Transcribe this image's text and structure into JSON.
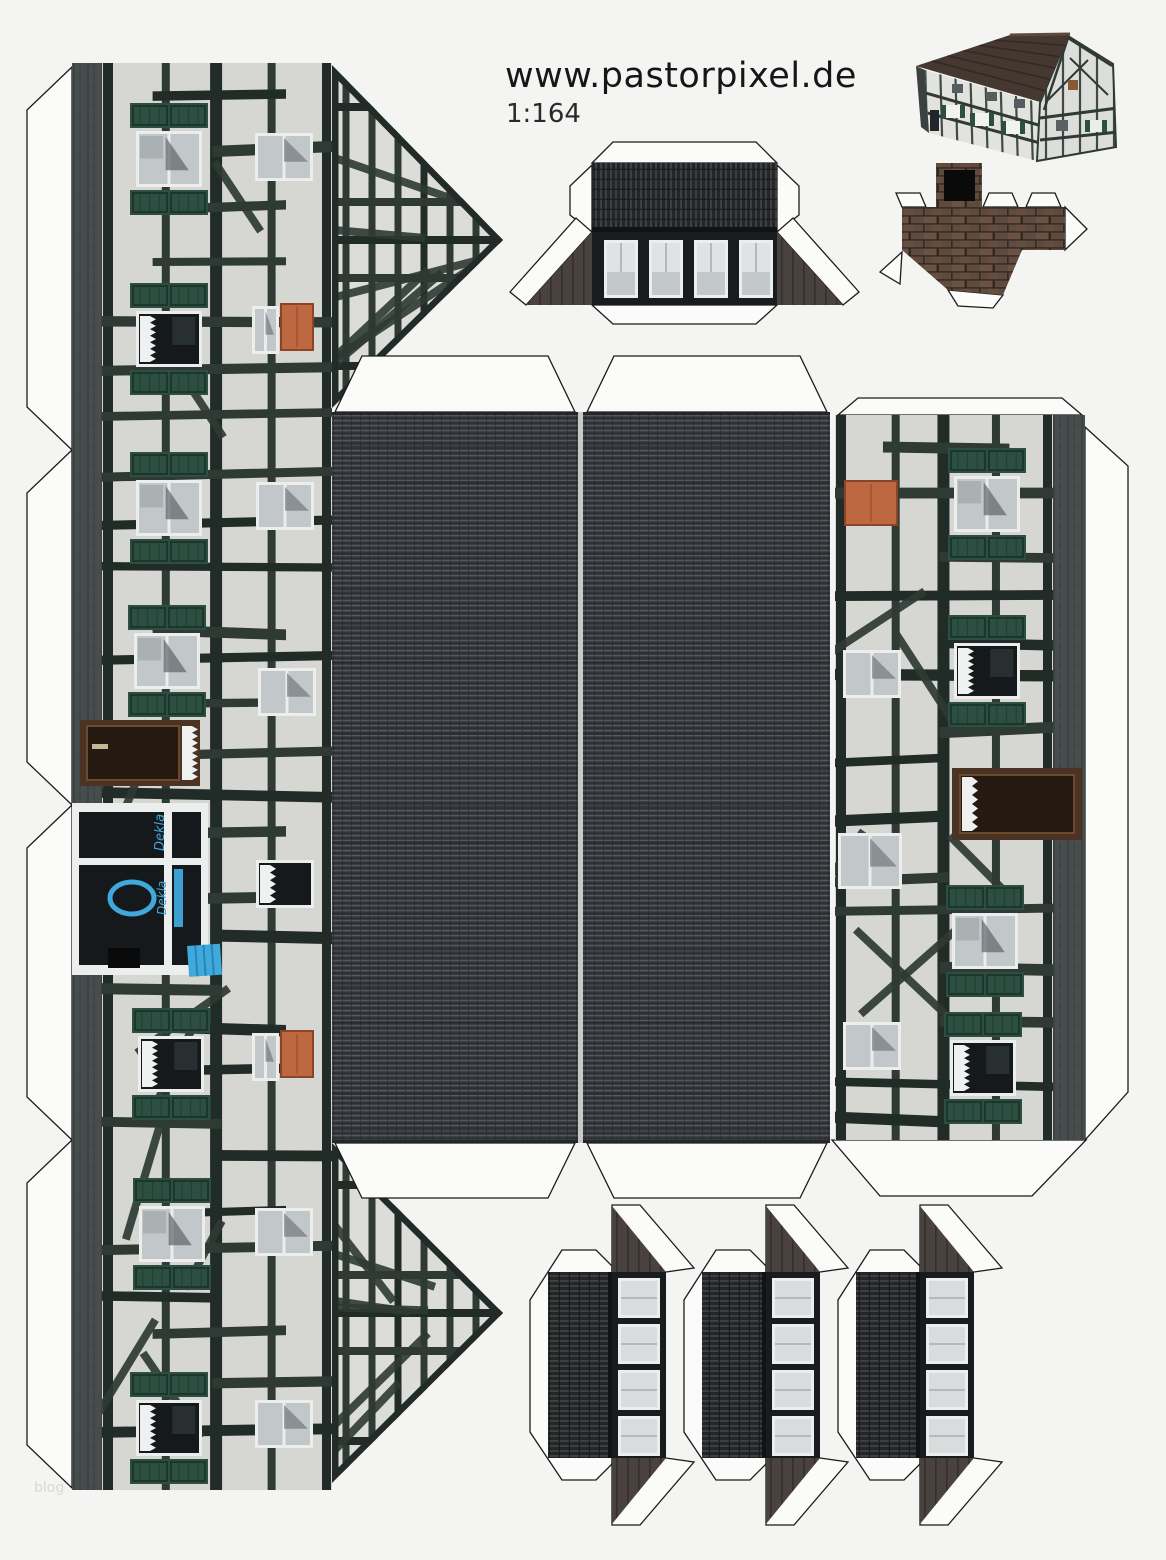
{
  "page": {
    "title": "www.pastorpixel.de",
    "scale_label": "1:164",
    "watermark": "blog",
    "background": "#f4f4f3"
  },
  "shop": {
    "sign_text": "Dekla"
  },
  "colors": {
    "outline": "#1b1b1b",
    "tab_fill": "#fbfbfa",
    "plaster": "#d6d7d3",
    "plaster2": "#dcddd9",
    "beam": "#212b27",
    "beam_soft": "#2f3a34",
    "shutter": "#2c4f42",
    "shutter_dark": "#1c362d",
    "plinth": "#474d4c",
    "plinth_dark": "#343a39",
    "roof_base": "#393d41",
    "roof_light": "#54595e",
    "roof_dark": "#24272a",
    "ridge_gap": "#c9cac7",
    "corr_base": "#232527",
    "corr_light": "#3d4043",
    "face_dark": "#191c1e",
    "wing": "#4a423e",
    "wing_dark": "#362f2c",
    "frame_white": "#eceded",
    "glass": "#c2c7c9",
    "glass_dark": "#15191c",
    "curtain": "#eff1f1",
    "orange": "#bd6841",
    "orange_dark": "#8a4526",
    "door_brown": "#4a3322",
    "door_brown_dark": "#241a10",
    "blue": "#3fa8dc",
    "blue_dark": "#2a84b5",
    "mortar": "#33291f",
    "brick1": "#5f4a3f",
    "brick2": "#6b5244",
    "preview_roof": "#453831",
    "preview_wall": "#e2e3df",
    "black": "#0a0a0a"
  },
  "pieces": {
    "left_facade": {
      "x": 72,
      "y": 63,
      "h": 1427,
      "plinth_w": 30,
      "wall_x": 102,
      "wall_w": 230,
      "gable_top": [
        [
          332,
          65
        ],
        [
          503,
          240
        ],
        [
          332,
          408
        ]
      ],
      "gable_bottom": [
        [
          332,
          1143
        ],
        [
          503,
          1313
        ],
        [
          332,
          1483
        ]
      ],
      "left_tab_breaks": [
        67,
        450,
        805,
        1140,
        1488
      ],
      "shuttered_windows": [
        {
          "x": 130,
          "y": 103
        },
        {
          "x": 130,
          "y": 283,
          "dark": true
        },
        {
          "x": 130,
          "y": 452
        },
        {
          "x": 128,
          "y": 605
        },
        {
          "x": 132,
          "y": 1008,
          "dark": true
        },
        {
          "x": 133,
          "y": 1178
        },
        {
          "x": 130,
          "y": 1372,
          "dark": true
        }
      ],
      "small_windows": [
        {
          "x": 255,
          "y": 133
        },
        {
          "x": 252,
          "y": 306,
          "w": 27
        },
        {
          "x": 256,
          "y": 482
        },
        {
          "x": 258,
          "y": 668
        },
        {
          "x": 256,
          "y": 860,
          "dark": true
        },
        {
          "x": 252,
          "y": 1033,
          "w": 27
        },
        {
          "x": 255,
          "y": 1208
        },
        {
          "x": 255,
          "y": 1400
        }
      ],
      "orange_doors": [
        {
          "x": 281,
          "y": 304
        },
        {
          "x": 281,
          "y": 1031
        }
      ],
      "shop": {
        "door": {
          "x": 80,
          "y": 720,
          "w": 120,
          "h": 66
        },
        "front": {
          "x": 72,
          "y": 803,
          "w": 136,
          "h": 172
        },
        "awning": {
          "x": 187,
          "y": 946,
          "w": 33,
          "h": 31
        },
        "black_sign": {
          "x": 108,
          "y": 948,
          "w": 32,
          "h": 20
        }
      }
    },
    "roof": {
      "panels": [
        [
          332,
          412,
          246,
          731
        ],
        [
          583,
          412,
          247,
          731
        ]
      ],
      "tabs": [
        [
          [
            335,
            412
          ],
          [
            362,
            356
          ],
          [
            548,
            356
          ],
          [
            575,
            412
          ]
        ],
        [
          [
            587,
            412
          ],
          [
            614,
            356
          ],
          [
            800,
            356
          ],
          [
            827,
            412
          ]
        ],
        [
          [
            335,
            1143
          ],
          [
            362,
            1198
          ],
          [
            548,
            1198
          ],
          [
            575,
            1143
          ]
        ],
        [
          [
            587,
            1143
          ],
          [
            614,
            1198
          ],
          [
            800,
            1198
          ],
          [
            827,
            1143
          ]
        ]
      ]
    },
    "right_facade": {
      "x": 835,
      "y": 415,
      "w": 250,
      "h": 725,
      "plinth_x": 1053,
      "plinth_w": 32,
      "shuttered_windows": [
        {
          "x": 948,
          "y": 448
        },
        {
          "x": 948,
          "y": 615,
          "dark": true
        },
        {
          "x": 946,
          "y": 885
        },
        {
          "x": 944,
          "y": 1012,
          "dark": true
        }
      ],
      "small_windows": [
        {
          "x": 843,
          "y": 650
        },
        {
          "x": 838,
          "y": 833,
          "w": 64,
          "h": 56
        },
        {
          "x": 843,
          "y": 1022
        }
      ],
      "orange_doors": [
        {
          "x": 845,
          "y": 481
        }
      ],
      "brown_door": {
        "x": 952,
        "y": 768,
        "w": 130,
        "h": 72
      },
      "tabs": {
        "top": [
          [
            838,
            415
          ],
          [
            858,
            398
          ],
          [
            1062,
            398
          ],
          [
            1082,
            415
          ]
        ],
        "right": [
          [
            1085,
            427
          ],
          [
            1128,
            466
          ],
          [
            1128,
            1092
          ],
          [
            1085,
            1140
          ]
        ],
        "bottom": [
          [
            832,
            1140
          ],
          [
            1086,
            1140
          ],
          [
            1032,
            1196
          ],
          [
            880,
            1196
          ]
        ]
      }
    },
    "dormer_large": {
      "roof": [
        592,
        163,
        185,
        69
      ],
      "face": [
        592,
        232,
        185,
        73
      ],
      "windows_y": 240,
      "windows_x": [
        604,
        649,
        694,
        739
      ],
      "win_w": 34,
      "win_h": 58,
      "wing_left": [
        [
          592,
          232
        ],
        [
          592,
          305
        ],
        [
          526,
          305
        ]
      ],
      "wing_right": [
        [
          777,
          232
        ],
        [
          777,
          305
        ],
        [
          843,
          305
        ]
      ]
    },
    "chimney": {
      "strip": [
        902,
        207,
        163,
        43
      ],
      "cap": [
        936,
        163,
        46,
        44
      ],
      "opening": [
        944,
        170,
        31,
        31
      ],
      "skirt": [
        [
          902,
          250
        ],
        [
          1022,
          250
        ],
        [
          1003,
          295
        ],
        [
          948,
          290
        ]
      ]
    },
    "small_dormers": {
      "xs": [
        548,
        702,
        856
      ],
      "y": 1272,
      "tile_w": 64,
      "win_w": 54,
      "h": 186,
      "win_x_off": 70,
      "win_w2": 42,
      "win_h": 40,
      "win_step": 46
    },
    "preview": {
      "roof": [
        [
          916,
          66
        ],
        [
          1010,
          35
        ],
        [
          1070,
          34
        ],
        [
          1040,
          102
        ]
      ],
      "front_wall": [
        [
          925,
          70
        ],
        [
          1040,
          103
        ],
        [
          1037,
          161
        ],
        [
          929,
          133
        ]
      ],
      "gable_wall": [
        [
          1040,
          103
        ],
        [
          1068,
          36
        ],
        [
          1113,
          64
        ],
        [
          1116,
          147
        ],
        [
          1037,
          161
        ]
      ]
    }
  }
}
